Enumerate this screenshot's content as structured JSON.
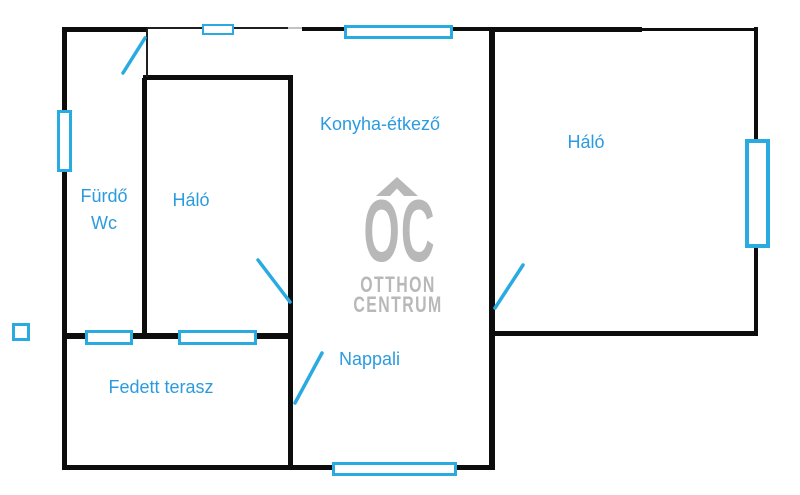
{
  "document": {
    "type": "floor-plan-drawing",
    "language": "hu"
  },
  "rooms": {
    "furdo": {
      "line1": "Fürdő",
      "line2": "Wc"
    },
    "halo_left": {
      "label": "Háló"
    },
    "konyha": {
      "label": "Konyha-étkező"
    },
    "halo_right": {
      "label": "Háló"
    },
    "fedett_terasz": {
      "label": "Fedett terasz"
    },
    "nappali": {
      "label": "Nappali"
    }
  },
  "watermark": {
    "logo": "OC",
    "line1": "OTTHON",
    "line2": "CENTRUM"
  },
  "elements": {
    "window_marker": "cyan-outlined-rectangle",
    "door_swing_marker": "cyan-diagonal-stroke",
    "detached_square_marker": "cyan-outlined-square",
    "roof_chevron": "gray-roof-chevron"
  },
  "colors": {
    "background": "#ffffff",
    "wall": "#0d0d0d",
    "window_accent": "#29abe2",
    "label_text": "#2b9be0",
    "watermark_gray": "#b8b8b8"
  }
}
